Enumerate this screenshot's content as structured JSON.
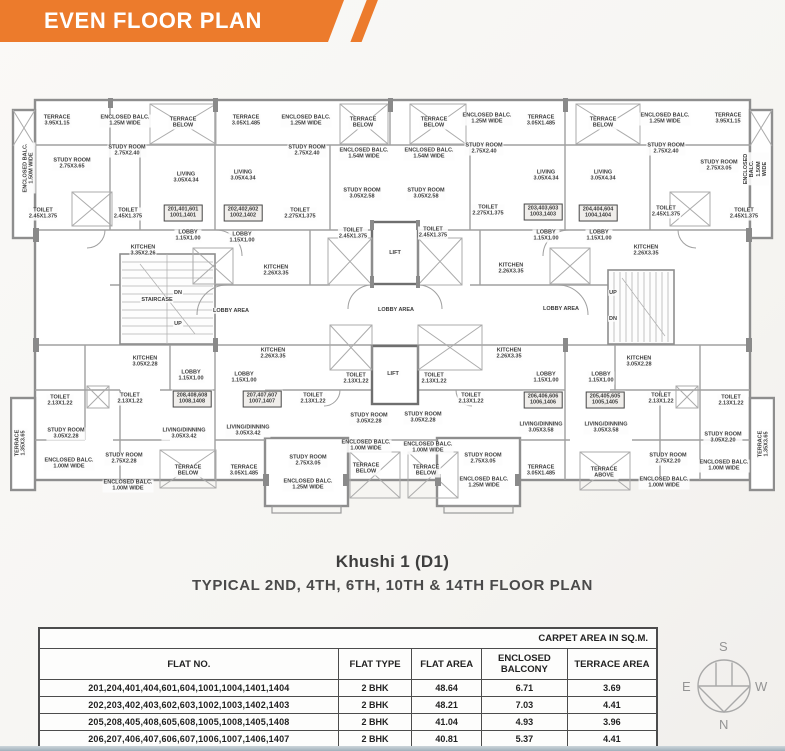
{
  "banner": {
    "title": "EVEN FLOOR PLAN",
    "color": "#ec7b2c"
  },
  "title": {
    "name": "Khushi 1 (D1)",
    "subtitle": "TYPICAL 2ND, 4TH, 6TH, 10TH & 14TH FLOOR PLAN"
  },
  "table": {
    "area_note": "CARPET AREA IN SQ.M.",
    "columns": [
      "FLAT NO.",
      "FLAT TYPE",
      "FLAT AREA",
      "ENCLOSED\nBALCONY",
      "TERRACE AREA"
    ],
    "rows": [
      [
        "201,204,401,404,601,604,1001,1004,1401,1404",
        "2 BHK",
        "48.64",
        "6.71",
        "3.69"
      ],
      [
        "202,203,402,403,602,603,1002,1003,1402,1403",
        "2 BHK",
        "48.21",
        "7.03",
        "4.41"
      ],
      [
        "205,208,405,408,605,608,1005,1008,1405,1408",
        "2 BHK",
        "41.04",
        "4.93",
        "3.96"
      ],
      [
        "206,207,406,407,606,607,1006,1007,1406,1407",
        "2 BHK",
        "40.81",
        "5.37",
        "4.41"
      ]
    ]
  },
  "compass": {
    "n": "N",
    "s": "S",
    "e": "E",
    "w": "W"
  },
  "plan": {
    "wall_color": "#8e8e8e",
    "labels": [
      {
        "t": "TERRACE\n3.95X1.15",
        "x": 47,
        "y": 33
      },
      {
        "t": "ENCLOSED BALC.\n1.25M WIDE",
        "x": 115,
        "y": 33
      },
      {
        "t": "TERRACE\nBELOW",
        "x": 173,
        "y": 35
      },
      {
        "t": "TERRACE\n3.05X1.485",
        "x": 236,
        "y": 33
      },
      {
        "t": "ENCLOSED BALC.\n1.25M WIDE",
        "x": 296,
        "y": 33
      },
      {
        "t": "TERRACE\nBELOW",
        "x": 353,
        "y": 35
      },
      {
        "t": "TERRACE\nBELOW",
        "x": 424,
        "y": 35
      },
      {
        "t": "ENCLOSED BALC.\n1.25M WIDE",
        "x": 477,
        "y": 31
      },
      {
        "t": "TERRACE\n3.05X1.485",
        "x": 531,
        "y": 33
      },
      {
        "t": "TERRACE\nBELOW",
        "x": 593,
        "y": 35
      },
      {
        "t": "ENCLOSED BALC.\n1.25M WIDE",
        "x": 655,
        "y": 31
      },
      {
        "t": "TERRACE\n3.95X1.15",
        "x": 718,
        "y": 31
      },
      {
        "t": "ENCLOSED BALC.\n1.50M WIDE",
        "x": 19,
        "y": 80,
        "r": 1
      },
      {
        "t": "ENCLOSED BALC.\n1.50M WIDE",
        "x": 746,
        "y": 81,
        "r": 1
      },
      {
        "t": "STUDY ROOM\n2.75X3.65",
        "x": 62,
        "y": 76
      },
      {
        "t": "STUDY ROOM\n2.75X2.40",
        "x": 117,
        "y": 63
      },
      {
        "t": "LIVING\n3.05X4.34",
        "x": 176,
        "y": 90
      },
      {
        "t": "LIVING\n3.05X4.34",
        "x": 233,
        "y": 88
      },
      {
        "t": "STUDY ROOM\n2.75X2.40",
        "x": 297,
        "y": 63
      },
      {
        "t": "ENCLOSED BALC.\n1.54M WIDE",
        "x": 354,
        "y": 66
      },
      {
        "t": "STUDY ROOM\n3.05X2.58",
        "x": 352,
        "y": 106
      },
      {
        "t": "ENCLOSED BALC.\n1.54M WIDE",
        "x": 419,
        "y": 66
      },
      {
        "t": "STUDY ROOM\n2.75X2.40",
        "x": 474,
        "y": 61
      },
      {
        "t": "STUDY ROOM\n3.05X2.58",
        "x": 416,
        "y": 106
      },
      {
        "t": "LIVING\n3.05X4.34",
        "x": 536,
        "y": 88
      },
      {
        "t": "LIVING\n3.05X4.34",
        "x": 593,
        "y": 88
      },
      {
        "t": "STUDY ROOM\n2.75X2.40",
        "x": 656,
        "y": 61
      },
      {
        "t": "STUDY ROOM\n2.75X3.05",
        "x": 709,
        "y": 78
      },
      {
        "t": "TOILET\n2.45X1.375",
        "x": 33,
        "y": 126
      },
      {
        "t": "TOILET\n2.45X1.375",
        "x": 118,
        "y": 126
      },
      {
        "t": "201,401,601\n1001,1401",
        "x": 173,
        "y": 125,
        "box": 1
      },
      {
        "t": "202,402,602\n1002,1402",
        "x": 233,
        "y": 125,
        "box": 1
      },
      {
        "t": "TOILET\n2.275X1.375",
        "x": 290,
        "y": 126
      },
      {
        "t": "TOILET\n2.45X1.375",
        "x": 343,
        "y": 146
      },
      {
        "t": "LIFT",
        "x": 385,
        "y": 165
      },
      {
        "t": "TOILET\n2.45X1.375",
        "x": 423,
        "y": 145
      },
      {
        "t": "TOILET\n2.275X1.375",
        "x": 478,
        "y": 123
      },
      {
        "t": "203,403,603\n1003,1403",
        "x": 533,
        "y": 124,
        "box": 1
      },
      {
        "t": "204,404,604\n1004,1404",
        "x": 588,
        "y": 125,
        "box": 1
      },
      {
        "t": "TOILET\n2.45X1.375",
        "x": 656,
        "y": 124
      },
      {
        "t": "TOILET\n2.45X1.375",
        "x": 734,
        "y": 126
      },
      {
        "t": "LOBBY\n1.15X1.00",
        "x": 178,
        "y": 148
      },
      {
        "t": "LOBBY\n1.15X1.00",
        "x": 232,
        "y": 150
      },
      {
        "t": "LOBBY\n1.15X1.00",
        "x": 536,
        "y": 148
      },
      {
        "t": "LOBBY\n1.15X1.00",
        "x": 589,
        "y": 148
      },
      {
        "t": "KITCHEN\n3.35X2.26",
        "x": 133,
        "y": 163
      },
      {
        "t": "KITCHEN\n2.26X3.35",
        "x": 266,
        "y": 183
      },
      {
        "t": "KITCHEN\n2.26X3.35",
        "x": 501,
        "y": 181
      },
      {
        "t": "KITCHEN\n2.26X3.35",
        "x": 636,
        "y": 163
      },
      {
        "t": "DN",
        "x": 168,
        "y": 205
      },
      {
        "t": "STAIRCASE",
        "x": 147,
        "y": 212
      },
      {
        "t": "UP",
        "x": 168,
        "y": 236
      },
      {
        "t": "LOBBY AREA",
        "x": 221,
        "y": 223
      },
      {
        "t": "LOBBY AREA",
        "x": 386,
        "y": 222
      },
      {
        "t": "LOBBY AREA",
        "x": 551,
        "y": 221
      },
      {
        "t": "UP",
        "x": 603,
        "y": 205
      },
      {
        "t": "DN",
        "x": 603,
        "y": 231
      },
      {
        "t": "LIFT",
        "x": 383,
        "y": 286
      },
      {
        "t": "TOILET\n2.13X1.22",
        "x": 346,
        "y": 291
      },
      {
        "t": "TOILET\n2.13X1.22",
        "x": 424,
        "y": 291
      },
      {
        "t": "KITCHEN\n3.05X2.28",
        "x": 135,
        "y": 274
      },
      {
        "t": "KITCHEN\n2.26X3.35",
        "x": 263,
        "y": 266
      },
      {
        "t": "KITCHEN\n2.26X3.35",
        "x": 499,
        "y": 266
      },
      {
        "t": "KITCHEN\n3.05X2.28",
        "x": 629,
        "y": 274
      },
      {
        "t": "LOBBY\n1.15X1.00",
        "x": 181,
        "y": 288
      },
      {
        "t": "LOBBY\n1.15X1.00",
        "x": 234,
        "y": 290
      },
      {
        "t": "LOBBY\n1.15X1.00",
        "x": 536,
        "y": 290
      },
      {
        "t": "LOBBY\n1.15X1.00",
        "x": 591,
        "y": 290
      },
      {
        "t": "208,408,608\n1008,1408",
        "x": 182,
        "y": 311,
        "box": 1
      },
      {
        "t": "207,407,607\n1007,1407",
        "x": 252,
        "y": 311,
        "box": 1
      },
      {
        "t": "206,406,606\n1006,1406",
        "x": 533,
        "y": 312,
        "box": 1
      },
      {
        "t": "205,405,605\n1005,1405",
        "x": 595,
        "y": 312,
        "box": 1
      },
      {
        "t": "TOILET\n2.13X1.22",
        "x": 50,
        "y": 313
      },
      {
        "t": "TOILET\n2.13X1.22",
        "x": 120,
        "y": 311
      },
      {
        "t": "TOILET\n2.13X1.22",
        "x": 303,
        "y": 311
      },
      {
        "t": "TOILET\n2.13X1.22",
        "x": 461,
        "y": 311
      },
      {
        "t": "TOILET\n2.13X1.22",
        "x": 651,
        "y": 311
      },
      {
        "t": "TOILET\n2.13X1.22",
        "x": 721,
        "y": 313
      },
      {
        "t": "STUDY ROOM\n3.05X2.28",
        "x": 56,
        "y": 346
      },
      {
        "t": "ENCLOSED BALC.\n1.00M WIDE",
        "x": 59,
        "y": 376
      },
      {
        "t": "STUDY ROOM\n2.75X2.28",
        "x": 114,
        "y": 371
      },
      {
        "t": "ENCLOSED BALC.\n1.00M WIDE",
        "x": 118,
        "y": 398
      },
      {
        "t": "LIVING/DINNING\n3.05X3.42",
        "x": 174,
        "y": 346
      },
      {
        "t": "TERRACE\nBELOW",
        "x": 178,
        "y": 383
      },
      {
        "t": "LIVING/DINNING\n3.05X3.42",
        "x": 238,
        "y": 343
      },
      {
        "t": "TERRACE\n3.05X1.485",
        "x": 234,
        "y": 383
      },
      {
        "t": "STUDY ROOM\n3.05X2.28",
        "x": 359,
        "y": 331
      },
      {
        "t": "ENCLOSED BALC.\n1.00M WIDE",
        "x": 356,
        "y": 358
      },
      {
        "t": "STUDY ROOM\n2.75X3.05",
        "x": 298,
        "y": 373
      },
      {
        "t": "ENCLOSED BALC.\n1.25M WIDE",
        "x": 298,
        "y": 397
      },
      {
        "t": "TERRACE\nBELOW",
        "x": 356,
        "y": 381
      },
      {
        "t": "TERRACE\nBELOW",
        "x": 416,
        "y": 383
      },
      {
        "t": "STUDY ROOM\n3.05X2.28",
        "x": 413,
        "y": 330
      },
      {
        "t": "ENCLOSED BALC.\n1.00M WIDE",
        "x": 418,
        "y": 360
      },
      {
        "t": "STUDY ROOM\n2.75X3.05",
        "x": 473,
        "y": 371
      },
      {
        "t": "ENCLOSED BALC.\n1.25M WIDE",
        "x": 474,
        "y": 395
      },
      {
        "t": "LIVING/DINNING\n3.05X3.58",
        "x": 531,
        "y": 340
      },
      {
        "t": "TERRACE\n3.05X1.485",
        "x": 531,
        "y": 383
      },
      {
        "t": "LIVING/DINNING\n3.05X3.58",
        "x": 596,
        "y": 340
      },
      {
        "t": "TERRACE\nABOVE",
        "x": 594,
        "y": 385
      },
      {
        "t": "STUDY ROOM\n2.75X2.20",
        "x": 658,
        "y": 371
      },
      {
        "t": "ENCLOSED BALC.\n1.00M WIDE",
        "x": 654,
        "y": 395
      },
      {
        "t": "STUDY ROOM\n3.05X2.20",
        "x": 713,
        "y": 350
      },
      {
        "t": "ENCLOSED BALC.\n1.00M WIDE",
        "x": 714,
        "y": 378
      },
      {
        "t": "TERRACE\n1.35X3.65",
        "x": 11,
        "y": 355,
        "r": 1
      },
      {
        "t": "TERRACE\n1.35X3.65",
        "x": 754,
        "y": 356,
        "r": 1
      }
    ]
  }
}
